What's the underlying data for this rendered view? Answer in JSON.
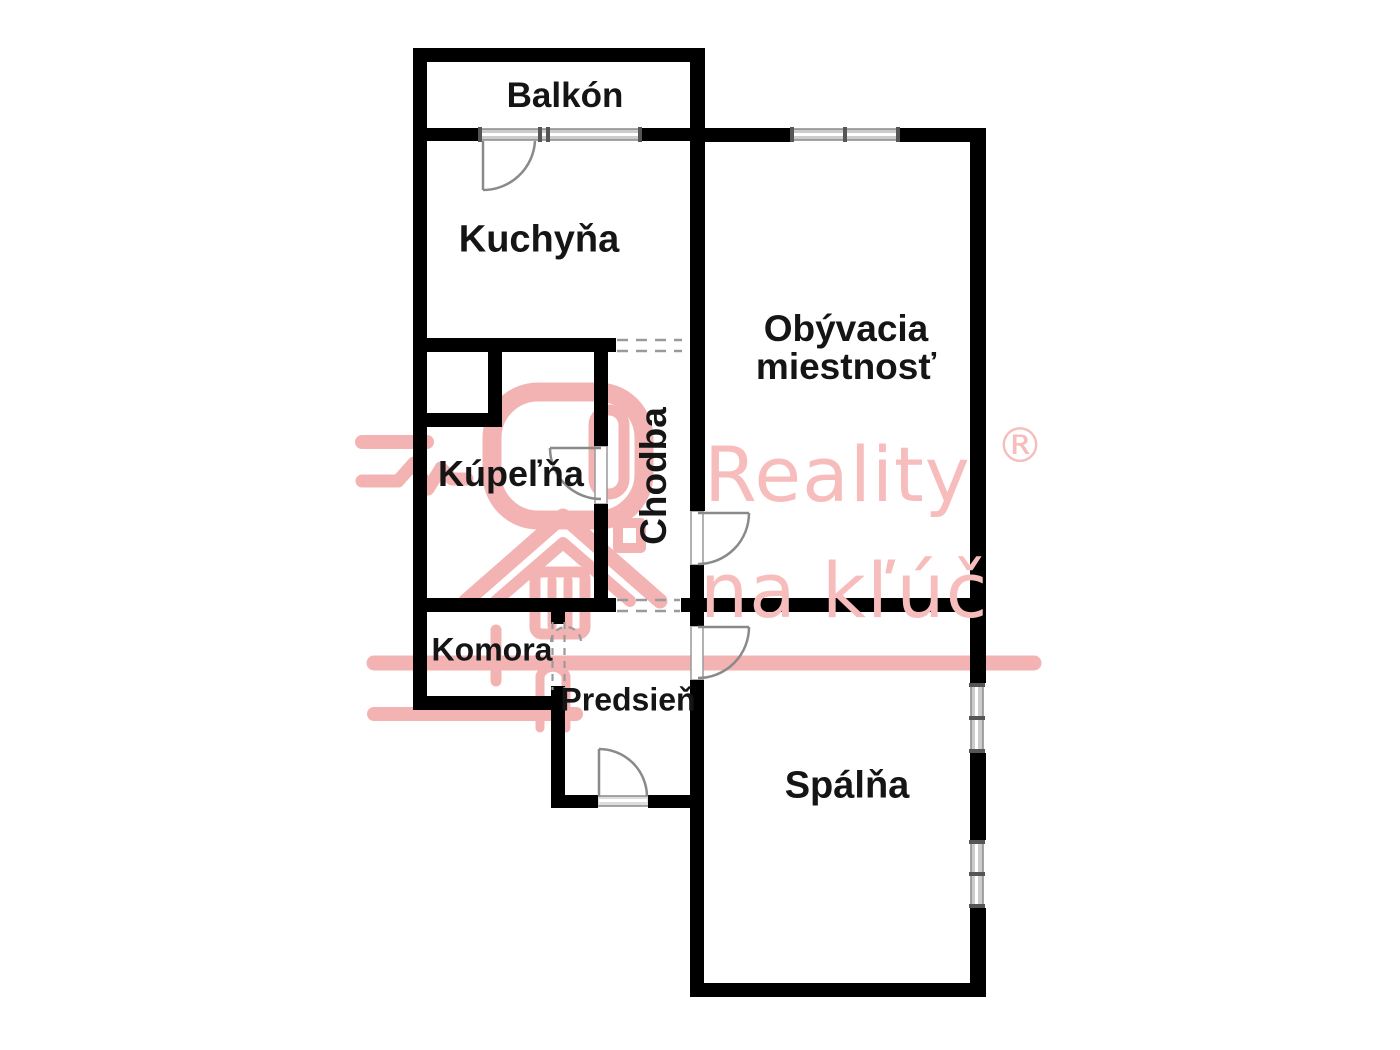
{
  "image_type": "apartment floor plan",
  "rooms": {
    "balcony": "Balkón",
    "kitchen": "Kuchyňa",
    "living_room_line1": "Obývacia",
    "living_room_line2": "miestnosť",
    "bathroom": "Kúpeľňa",
    "hallway": "Chodba",
    "pantry": "Komora",
    "vestibule": "Predsieň",
    "bedroom": "Spálňa"
  },
  "watermark": {
    "brand_word": "Reality",
    "registered_symbol": "®",
    "tagline": "na kľúč",
    "text_color": "#f7bdbd",
    "logo_color": "#f4b3b3"
  },
  "colors": {
    "background": "#ffffff",
    "wall": "#000000",
    "door_line": "#8a8a8a",
    "window_fill": "#cccccc",
    "window_tick": "#555555",
    "dashed_opening": "#9a9a9a",
    "label_text": "#151515"
  }
}
